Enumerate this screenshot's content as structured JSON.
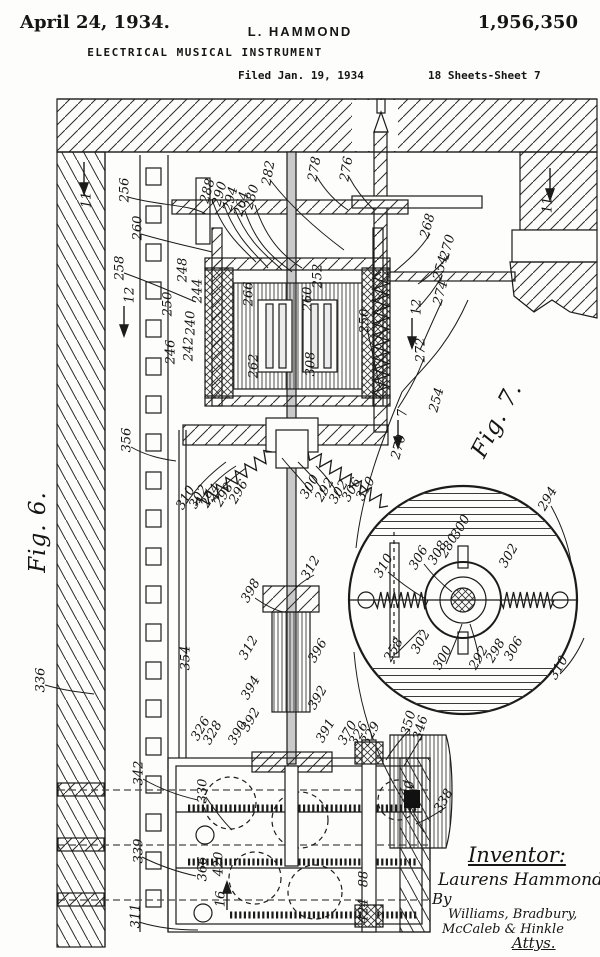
{
  "header": {
    "date": "April 24, 1934.",
    "inventor_name": "L. HAMMOND",
    "patent_number": "1,956,350",
    "title": "ELECTRICAL MUSICAL INSTRUMENT",
    "filed": "Filed Jan. 19, 1934",
    "sheet": "18 Sheets-Sheet 7"
  },
  "figures": [
    {
      "label": "Fig. 6.",
      "x": 38,
      "y": 532,
      "r": -90
    },
    {
      "label": "Fig. 7.",
      "x": 497,
      "y": 420,
      "r": -62
    }
  ],
  "signature": {
    "inventor_heading": "Inventor:",
    "inventor": "Laurens Hammond",
    "by": "By",
    "attorneys_line1": "Williams, Bradbury,",
    "attorneys_line2": "McCaleb & Hinkle",
    "attys": "Attys."
  },
  "colors": {
    "ink": "#1b1b1b",
    "paper": "#fdfdfb"
  },
  "reference_labels": [
    {
      "t": "11",
      "x": 87,
      "y": 200,
      "r": -90
    },
    {
      "t": "11",
      "x": 548,
      "y": 205,
      "r": -90
    },
    {
      "t": "12",
      "x": 130,
      "y": 295,
      "r": -90
    },
    {
      "t": "12",
      "x": 417,
      "y": 307,
      "r": -90
    },
    {
      "t": "7",
      "x": 403,
      "y": 413,
      "r": -90
    },
    {
      "t": "16",
      "x": 221,
      "y": 899,
      "r": -90
    },
    {
      "t": "256",
      "x": 125,
      "y": 190,
      "r": -90
    },
    {
      "t": "260",
      "x": 138,
      "y": 228,
      "r": -90
    },
    {
      "t": "258",
      "x": 120,
      "y": 268,
      "r": -90
    },
    {
      "t": "288",
      "x": 208,
      "y": 191,
      "r": -75
    },
    {
      "t": "290",
      "x": 220,
      "y": 194,
      "r": -75
    },
    {
      "t": "294",
      "x": 231,
      "y": 199,
      "r": -75
    },
    {
      "t": "264",
      "x": 242,
      "y": 204,
      "r": -75
    },
    {
      "t": "280",
      "x": 252,
      "y": 197,
      "r": -75
    },
    {
      "t": "282",
      "x": 269,
      "y": 173,
      "r": -80
    },
    {
      "t": "278",
      "x": 315,
      "y": 169,
      "r": -80
    },
    {
      "t": "276",
      "x": 347,
      "y": 169,
      "r": -80
    },
    {
      "t": "268",
      "x": 428,
      "y": 226,
      "r": -75
    },
    {
      "t": "270",
      "x": 448,
      "y": 247,
      "r": -75
    },
    {
      "t": "254",
      "x": 441,
      "y": 268,
      "r": -75
    },
    {
      "t": "274",
      "x": 441,
      "y": 293,
      "r": -75
    },
    {
      "t": "272",
      "x": 421,
      "y": 350,
      "r": -90
    },
    {
      "t": "254",
      "x": 437,
      "y": 400,
      "r": -75
    },
    {
      "t": "250",
      "x": 365,
      "y": 321,
      "r": -90
    },
    {
      "t": "248",
      "x": 183,
      "y": 270,
      "r": -90
    },
    {
      "t": "244",
      "x": 198,
      "y": 291,
      "r": -90
    },
    {
      "t": "240",
      "x": 191,
      "y": 323,
      "r": -90
    },
    {
      "t": "242",
      "x": 189,
      "y": 349,
      "r": -90
    },
    {
      "t": "246",
      "x": 171,
      "y": 352,
      "r": -90
    },
    {
      "t": "250",
      "x": 168,
      "y": 304,
      "r": -90
    },
    {
      "t": "266",
      "x": 249,
      "y": 294,
      "r": -90
    },
    {
      "t": "260",
      "x": 308,
      "y": 299,
      "r": -90
    },
    {
      "t": "252",
      "x": 318,
      "y": 276,
      "r": -90
    },
    {
      "t": "262",
      "x": 254,
      "y": 366,
      "r": -90
    },
    {
      "t": "308",
      "x": 311,
      "y": 364,
      "r": -90
    },
    {
      "t": "356",
      "x": 127,
      "y": 440,
      "r": -90
    },
    {
      "t": "310",
      "x": 186,
      "y": 498,
      "r": -60
    },
    {
      "t": "302",
      "x": 199,
      "y": 497,
      "r": -60
    },
    {
      "t": "294",
      "x": 211,
      "y": 496,
      "r": -60
    },
    {
      "t": "298",
      "x": 224,
      "y": 495,
      "r": -60
    },
    {
      "t": "296",
      "x": 239,
      "y": 492,
      "r": -60
    },
    {
      "t": "300",
      "x": 310,
      "y": 487,
      "r": -60
    },
    {
      "t": "292",
      "x": 325,
      "y": 490,
      "r": -60
    },
    {
      "t": "302",
      "x": 339,
      "y": 492,
      "r": -60
    },
    {
      "t": "306",
      "x": 352,
      "y": 490,
      "r": -60
    },
    {
      "t": "310",
      "x": 366,
      "y": 489,
      "r": -60
    },
    {
      "t": "270",
      "x": 399,
      "y": 447,
      "r": -75
    },
    {
      "t": "336",
      "x": 41,
      "y": 680,
      "r": -90
    },
    {
      "t": "312",
      "x": 311,
      "y": 568,
      "r": -60
    },
    {
      "t": "398",
      "x": 251,
      "y": 591,
      "r": -60
    },
    {
      "t": "312",
      "x": 249,
      "y": 648,
      "r": -60
    },
    {
      "t": "394",
      "x": 251,
      "y": 688,
      "r": -60
    },
    {
      "t": "392",
      "x": 251,
      "y": 720,
      "r": -60
    },
    {
      "t": "390",
      "x": 238,
      "y": 733,
      "r": -60
    },
    {
      "t": "326",
      "x": 201,
      "y": 729,
      "r": -60
    },
    {
      "t": "328",
      "x": 213,
      "y": 733,
      "r": -60
    },
    {
      "t": "354",
      "x": 186,
      "y": 658,
      "r": -90
    },
    {
      "t": "396",
      "x": 318,
      "y": 651,
      "r": -60
    },
    {
      "t": "392",
      "x": 318,
      "y": 698,
      "r": -60
    },
    {
      "t": "391",
      "x": 326,
      "y": 731,
      "r": -60
    },
    {
      "t": "370",
      "x": 348,
      "y": 733,
      "r": -60
    },
    {
      "t": "326",
      "x": 359,
      "y": 734,
      "r": -60
    },
    {
      "t": "329",
      "x": 371,
      "y": 734,
      "r": -60
    },
    {
      "t": "294",
      "x": 548,
      "y": 499,
      "r": -60
    },
    {
      "t": "310",
      "x": 384,
      "y": 566,
      "r": -60
    },
    {
      "t": "306",
      "x": 419,
      "y": 558,
      "r": -60
    },
    {
      "t": "308",
      "x": 438,
      "y": 553,
      "r": -60
    },
    {
      "t": "280",
      "x": 449,
      "y": 546,
      "r": -60
    },
    {
      "t": "300",
      "x": 461,
      "y": 527,
      "r": -60
    },
    {
      "t": "302",
      "x": 509,
      "y": 556,
      "r": -60
    },
    {
      "t": "258",
      "x": 394,
      "y": 650,
      "r": -60
    },
    {
      "t": "302",
      "x": 421,
      "y": 642,
      "r": -60
    },
    {
      "t": "300",
      "x": 443,
      "y": 658,
      "r": -60
    },
    {
      "t": "292",
      "x": 479,
      "y": 658,
      "r": -60
    },
    {
      "t": "298",
      "x": 496,
      "y": 651,
      "r": -60
    },
    {
      "t": "306",
      "x": 514,
      "y": 649,
      "r": -60
    },
    {
      "t": "310",
      "x": 559,
      "y": 668,
      "r": -60
    },
    {
      "t": "342",
      "x": 139,
      "y": 773,
      "r": -90
    },
    {
      "t": "330",
      "x": 203,
      "y": 791,
      "r": -90
    },
    {
      "t": "339",
      "x": 139,
      "y": 851,
      "r": -90
    },
    {
      "t": "311",
      "x": 136,
      "y": 916,
      "r": -90
    },
    {
      "t": "366",
      "x": 203,
      "y": 869,
      "r": -90
    },
    {
      "t": "420",
      "x": 219,
      "y": 864,
      "r": -90
    },
    {
      "t": "88",
      "x": 364,
      "y": 879,
      "r": -90
    },
    {
      "t": "424",
      "x": 364,
      "y": 911,
      "r": -90
    },
    {
      "t": "350",
      "x": 409,
      "y": 723,
      "r": -75
    },
    {
      "t": "346",
      "x": 421,
      "y": 728,
      "r": -75
    },
    {
      "t": "338",
      "x": 444,
      "y": 801,
      "r": -60
    },
    {
      "t": "430",
      "x": 410,
      "y": 793,
      "r": -90
    }
  ]
}
